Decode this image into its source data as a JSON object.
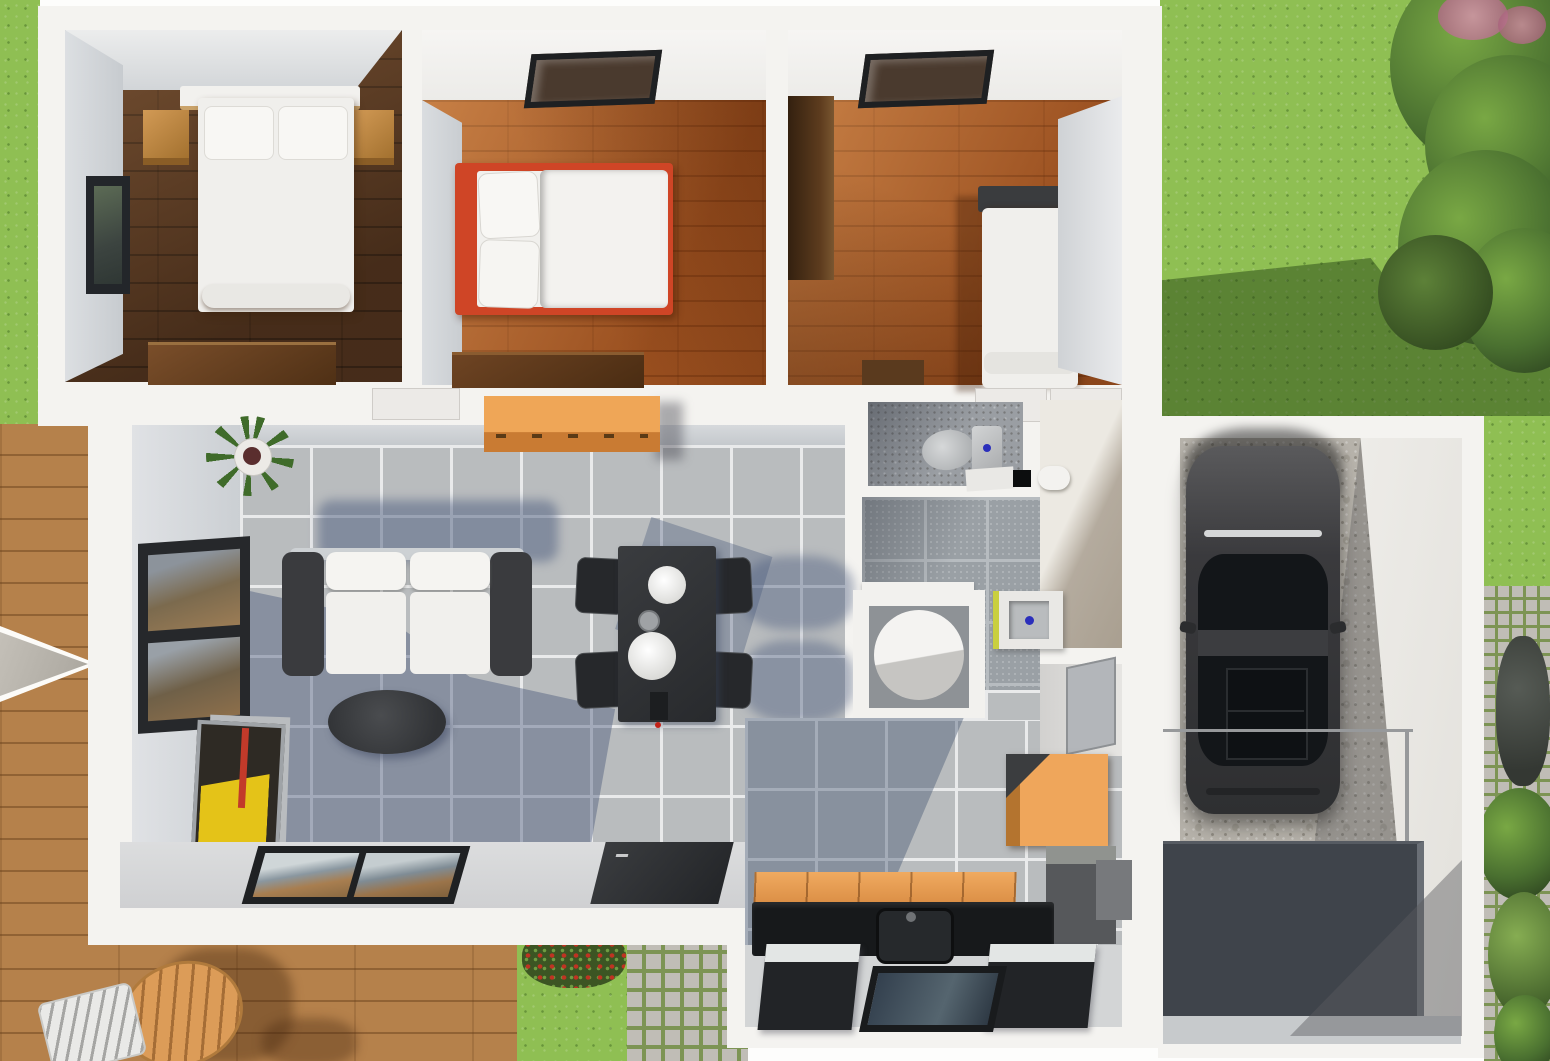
{
  "scene": {
    "view": "top-down 3D architectural floor plan rendering of a single-storey house with garage and garden",
    "rooms": [
      {
        "name": "bedroom-1",
        "floor": "dark walnut wood",
        "objects": [
          "double-bed",
          "pillow",
          "headboard-shelf",
          "nightstand-left",
          "nightstand-right",
          "dresser",
          "window"
        ]
      },
      {
        "name": "bedroom-2",
        "floor": "oak wood",
        "objects": [
          "bed-red-frame",
          "pillows",
          "duvet",
          "desk",
          "skylight"
        ]
      },
      {
        "name": "bedroom-3",
        "floor": "oak wood",
        "objects": [
          "wardrobe",
          "single-bed",
          "headboard",
          "skylight"
        ]
      },
      {
        "name": "living-dining-room",
        "floor": "grey ceramic tile",
        "objects": [
          "sofa",
          "coffee-table",
          "potted-plant",
          "sideboard",
          "leaning-artwork",
          "dining-table",
          "dining-chairs",
          "tableware",
          "picture-window",
          "sliding-glass-door",
          "front-door"
        ]
      },
      {
        "name": "wc",
        "floor": "speckled grey tile",
        "objects": [
          "toilet",
          "cistern",
          "shelf-niche"
        ]
      },
      {
        "name": "bathroom",
        "floor": "grey tile",
        "objects": [
          "washbasin-unit",
          "round-shower",
          "ledge"
        ]
      },
      {
        "name": "hallway",
        "floor": "cream screed",
        "objects": [
          "wall-basin"
        ]
      },
      {
        "name": "kitchen",
        "floor": "grey tile / light screed",
        "objects": [
          "orange-cabinet-row",
          "black-counter",
          "kitchen-sink",
          "tall-orange-cabinet",
          "grey-appliance",
          "island-unit-left",
          "island-unit-right",
          "floor-glass-hatch",
          "wall-panel"
        ]
      },
      {
        "name": "garage",
        "floor": "concrete",
        "objects": [
          "car",
          "driveway-ramp",
          "glass-railing"
        ]
      }
    ],
    "outdoor": [
      "lawn",
      "tree-cluster",
      "shrubs",
      "wooden-deck",
      "patio-table",
      "patio-chair",
      "parasol",
      "cobblestone-path",
      "stepping-stones",
      "flowering-red-bush"
    ]
  },
  "colors": {
    "grass": "#8fbf53",
    "deck": "#b5814b",
    "tile": "#b9bcbe",
    "grout": "#e9eaeb",
    "bathtile": "#9aa0a5",
    "wall": "#f4f3f0",
    "wallface": "#d6d9dc",
    "walnut": "#5d3b22",
    "oak": "#aa5c28",
    "orange": "#efa65b",
    "redframe": "#cf4526",
    "sofa": "#3a3b3e",
    "cushion": "#f1f0ed",
    "counter": "#17191b",
    "car": "#38393c",
    "concrete": "#b6b2aa",
    "moss": "#7d9454",
    "cobble": "#c0bdb6",
    "drive": "#3f444b",
    "cream": "#ece9e2",
    "woodfurn": "#6e4423",
    "treedark": "#2c421f",
    "treemid": "#4a7030",
    "treelight": "#79a844"
  }
}
